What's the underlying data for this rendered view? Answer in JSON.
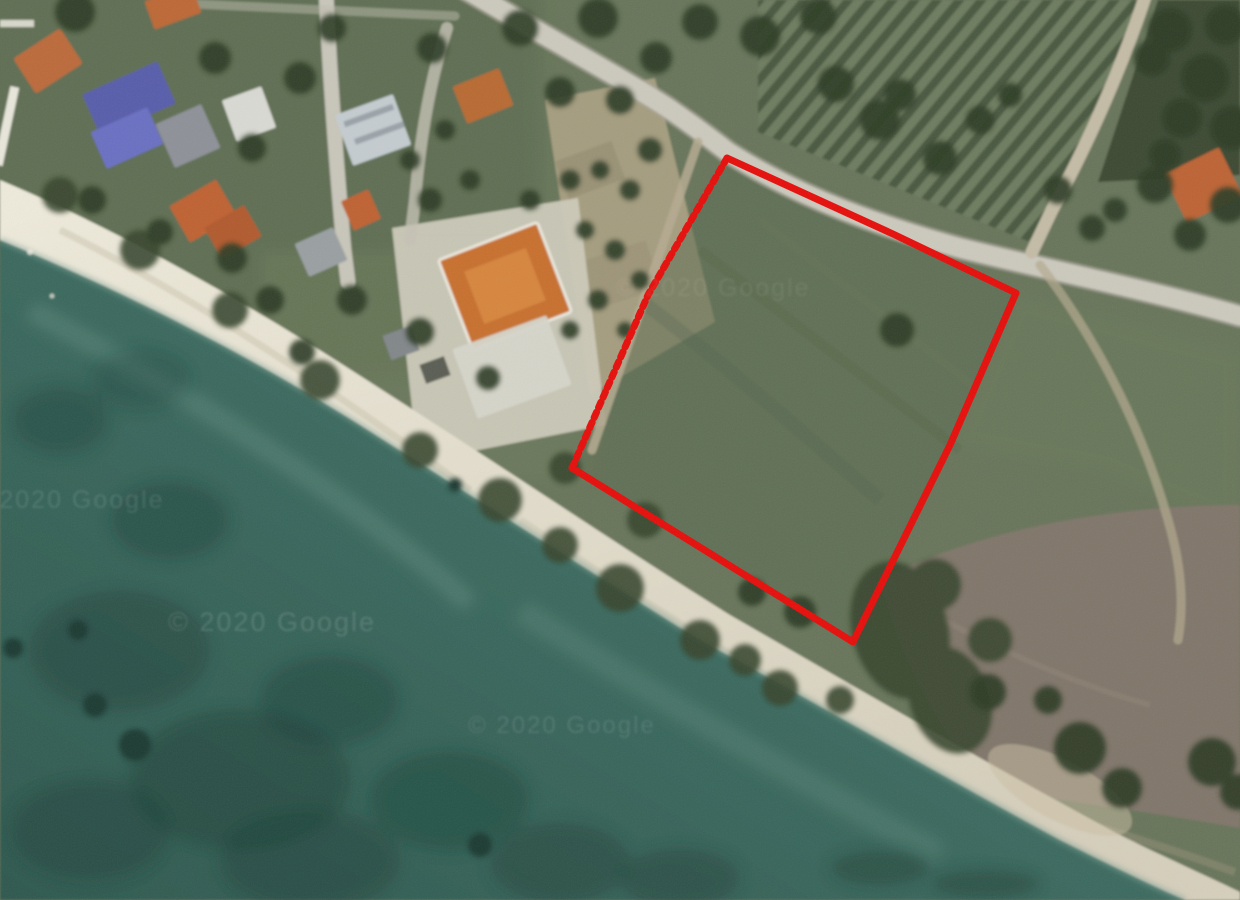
{
  "map": {
    "kind_label": "",
    "watermarks": [
      {
        "text": "© 2020 Google"
      },
      {
        "text": "© 2020 Google"
      },
      {
        "text": "© 2020 Google"
      },
      {
        "text": "© 2020 Google"
      }
    ],
    "plot_outline": {
      "color": "#e60d0a",
      "solid_points": "727,158 893,234 1016,293 950,445 853,642 572,468",
      "dashed_points": "572,468 648,295 727,158",
      "fill_points": "727,158 893,234 1016,293 950,445 853,642 572,468 648,295"
    },
    "palette": {
      "sea_deep": "#2e594f",
      "sea_shallow": "#4e7d71",
      "sand": "#e6e1d1",
      "land_green": "#67755a",
      "road_gray": "#ccc9bd",
      "roof_orange": "#c06a38",
      "roof_blue": "#585dab",
      "church_roof": "#c8702f",
      "scrub_green": "#38462e",
      "bare_field": "#80766a",
      "outline_red": "#e60d0a"
    }
  }
}
